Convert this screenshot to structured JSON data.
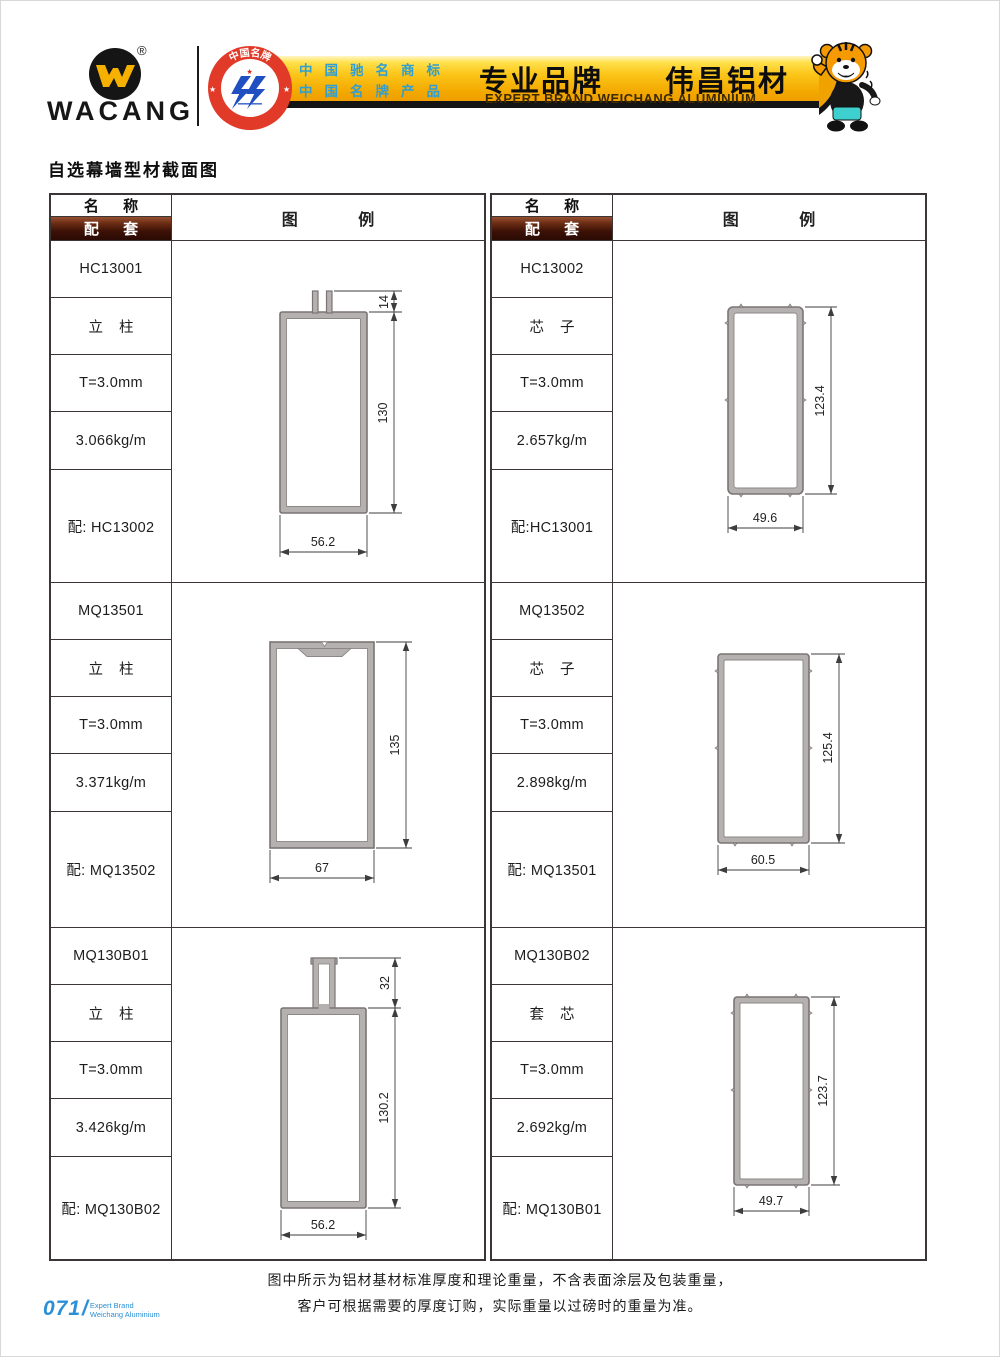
{
  "header": {
    "brand": "WACANG",
    "registered_mark": "®",
    "badge": {
      "top_text": "中国名牌",
      "bottom_text": "CHINA TOP BRAND",
      "ring_color": "#e23a28",
      "glyph_color": "#1f4fc0"
    },
    "banner": {
      "cert_line1": "中国驰名商标",
      "cert_line2": "中国名牌产品",
      "title_cn": "专业品牌　　伟昌铝材",
      "title_en": "EXPERT BRAND WEICHANG ALUMINIUM",
      "gold_color": "#f6b800",
      "cert_text_color": "#2e9fd4"
    }
  },
  "page_title": "自选幕墙型材截面图",
  "table": {
    "header_name": "名 称",
    "header_match": "配 套",
    "header_legend": "图 例",
    "match_bg_color": "#3c1106"
  },
  "profiles": [
    {
      "code": "HC13001",
      "type": "立 柱",
      "thickness": "T=3.0mm",
      "weight": "3.066kg/m",
      "match": "配: HC13002",
      "dim_width": "56.2",
      "dim_height": "130",
      "dim_top": "14"
    },
    {
      "code": "HC13002",
      "type": "芯 子",
      "thickness": "T=3.0mm",
      "weight": "2.657kg/m",
      "match": "配:HC13001",
      "dim_width": "49.6",
      "dim_height": "123.4"
    },
    {
      "code": "MQ13501",
      "type": "立 柱",
      "thickness": "T=3.0mm",
      "weight": "3.371kg/m",
      "match": "配: MQ13502",
      "dim_width": "67",
      "dim_height": "135"
    },
    {
      "code": "MQ13502",
      "type": "芯 子",
      "thickness": "T=3.0mm",
      "weight": "2.898kg/m",
      "match": "配: MQ13501",
      "dim_width": "60.5",
      "dim_height": "125.4"
    },
    {
      "code": "MQ130B01",
      "type": "立 柱",
      "thickness": "T=3.0mm",
      "weight": "3.426kg/m",
      "match": "配: MQ130B02",
      "dim_width": "56.2",
      "dim_height": "130.2",
      "dim_top": "32"
    },
    {
      "code": "MQ130B02",
      "type": "套 芯",
      "thickness": "T=3.0mm",
      "weight": "2.692kg/m",
      "match": "配: MQ130B01",
      "dim_width": "49.7",
      "dim_height": "123.7"
    }
  ],
  "note": {
    "line1": "图中所示为铝材基材标准厚度和理论重量，不含表面涂层及包装重量，",
    "line2": "客户可根据需要的厚度订购，实际重量以过磅时的重量为准。"
  },
  "footer": {
    "page_number": "071",
    "slash": "/",
    "label_line1": "Expert Brand",
    "label_line2": "Weichang Aluminium",
    "accent_color": "#2a8fd6"
  },
  "drawing": {
    "wall_fill": "#b5b1b1",
    "wall_stroke": "#7b7474",
    "dim_color": "#3d3d3d"
  }
}
